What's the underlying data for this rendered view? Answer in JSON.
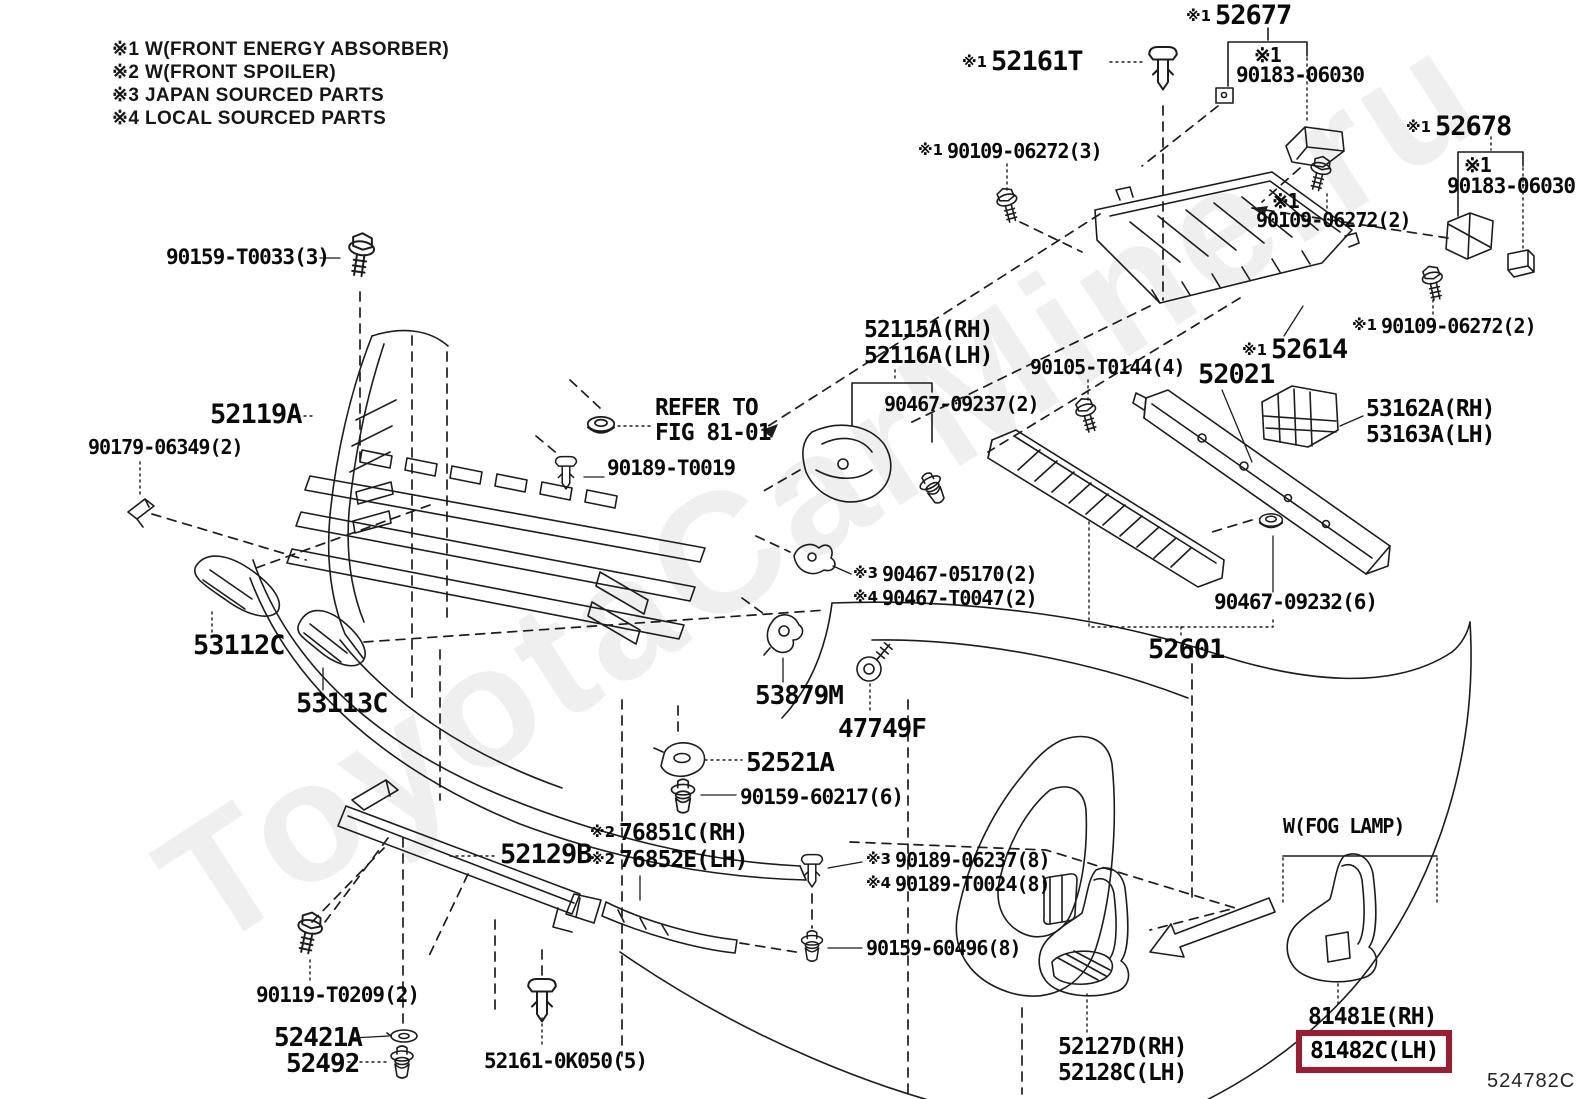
{
  "meta": {
    "figure_code": "524782C",
    "watermark": "ToyotaCarMine.ru",
    "highlight_color": "#9e1b32"
  },
  "legend": [
    "※1 W(FRONT ENERGY ABSORBER)",
    "※2 W(FRONT SPOILER)",
    "※3 JAPAN SOURCED PARTS",
    "※4 LOCAL SOURCED PARTS"
  ],
  "labels": {
    "n52677": {
      "prefix": "※1",
      "num": "52677"
    },
    "n52161t": {
      "prefix": "※1",
      "num": "52161T"
    },
    "n90183a_p": {
      "prefix": "※1"
    },
    "n90183a": {
      "num": "90183-06030"
    },
    "n90109_3": {
      "prefix": "※1",
      "num": "90109-06272(3)"
    },
    "n52678": {
      "prefix": "※1",
      "num": "52678"
    },
    "n90183b_p": {
      "prefix": "※1"
    },
    "n90183b": {
      "num": "90183-06030"
    },
    "n90109_2g_p": {
      "prefix": "※1"
    },
    "n90109_2g": {
      "num": "90109-06272(2)"
    },
    "n90109_2r": {
      "prefix": "※1",
      "num": "90109-06272(2)"
    },
    "n52614": {
      "prefix": "※1",
      "num": "52614"
    },
    "n52115a": {
      "num": "52115A(RH)"
    },
    "n52116a": {
      "num": "52116A(LH)"
    },
    "n90467_09237": {
      "num": "90467-09237(2)"
    },
    "n90105": {
      "num": "90105-T0144(4)"
    },
    "n52021": {
      "num": "52021"
    },
    "n53162a": {
      "num": "53162A(RH)"
    },
    "n53163a": {
      "num": "53163A(LH)"
    },
    "n90159_t0033": {
      "num": "90159-T0033(3)"
    },
    "n52119a": {
      "num": "52119A"
    },
    "n90179": {
      "num": "90179-06349(2)"
    },
    "refer1": {
      "num": "REFER TO"
    },
    "refer2": {
      "num": "FIG 81-01"
    },
    "n90189_t0019": {
      "num": "90189-T0019"
    },
    "n53112c": {
      "num": "53112C"
    },
    "n53113c": {
      "num": "53113C"
    },
    "n90467_05170": {
      "prefix": "※3",
      "num": "90467-05170(2)"
    },
    "n90467_t0047": {
      "prefix": "※4",
      "num": "90467-T0047(2)"
    },
    "n53879m": {
      "num": "53879M"
    },
    "n47749f": {
      "num": "47749F"
    },
    "n52521a": {
      "num": "52521A"
    },
    "n90159_60217": {
      "num": "90159-60217(6)"
    },
    "n52601": {
      "num": "52601"
    },
    "n90467_09232": {
      "num": "90467-09232(6)"
    },
    "n76851c": {
      "prefix": "※2",
      "num": "76851C(RH)"
    },
    "n76852e": {
      "prefix": "※2",
      "num": "76852E(LH)"
    },
    "n52129b": {
      "num": "52129B"
    },
    "n90189_06237": {
      "prefix": "※3",
      "num": "90189-06237(8)"
    },
    "n90189_t0024": {
      "prefix": "※4",
      "num": "90189-T0024(8)"
    },
    "n90159_60496": {
      "num": "90159-60496(8)"
    },
    "n90119": {
      "num": "90119-T0209(2)"
    },
    "n52421a": {
      "num": "52421A"
    },
    "n52492": {
      "num": "52492"
    },
    "n52161_0k050": {
      "num": "52161-0K050(5)"
    },
    "n52127d": {
      "num": "52127D(RH)"
    },
    "n52128c": {
      "num": "52128C(LH)"
    },
    "fog": {
      "num": "W(FOG LAMP)"
    },
    "n81481e": {
      "num": "81481E(RH)"
    },
    "n81482c": {
      "num": "81482C(LH)"
    }
  }
}
